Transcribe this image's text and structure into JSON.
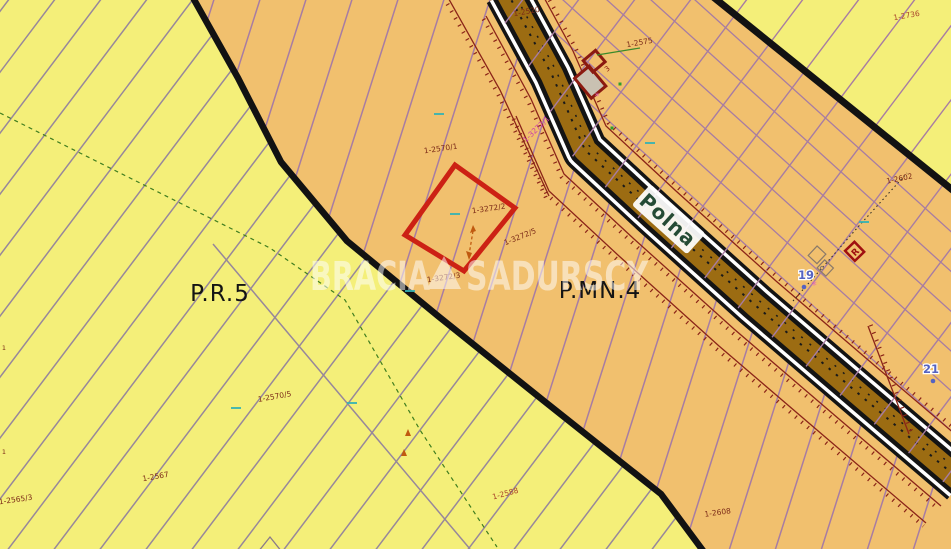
{
  "zones": {
    "left": "P.R.5",
    "right": "P.MN.4"
  },
  "road": {
    "name": "Polna"
  },
  "watermark": {
    "left": "BRACIA",
    "right": "SADURSCY"
  },
  "selected_parcel": {
    "label": "1-3272/2"
  },
  "labels": [
    {
      "t": "1-2520",
      "x": 527,
      "y": 14,
      "r": -10
    },
    {
      "t": "1-2575",
      "x": 640,
      "y": 45,
      "r": -10
    },
    {
      "t": "1-2736",
      "x": 907,
      "y": 18,
      "r": -10,
      "c": "#a8432a"
    },
    {
      "t": "1-2602",
      "x": 900,
      "y": 181,
      "r": -12
    },
    {
      "t": "1-2570/1",
      "x": 441,
      "y": 151,
      "r": -8
    },
    {
      "t": "1-3272/1",
      "x": 538,
      "y": 131,
      "r": -44,
      "c": "#cc3fa8"
    },
    {
      "t": "1-3272/2",
      "x": 489,
      "y": 211,
      "r": -8
    },
    {
      "t": "1-3272/5",
      "x": 521,
      "y": 239,
      "r": -22
    },
    {
      "t": "1-3272/3",
      "x": 444,
      "y": 280,
      "r": -8
    },
    {
      "t": "1-2570/5",
      "x": 275,
      "y": 399,
      "r": -10
    },
    {
      "t": "1-2567",
      "x": 156,
      "y": 479,
      "r": -10
    },
    {
      "t": "1-2565/3",
      "x": 16,
      "y": 502,
      "r": -8
    },
    {
      "t": "1-2588",
      "x": 506,
      "y": 496,
      "r": -15,
      "c": "#a8432a"
    },
    {
      "t": "1-2608",
      "x": 718,
      "y": 515,
      "r": -8
    },
    {
      "t": "1",
      "x": 4,
      "y": 350,
      "r": 0,
      "s": 6.5
    },
    {
      "t": "1",
      "x": 4,
      "y": 454,
      "r": 0,
      "s": 6.5
    }
  ],
  "markers": {
    "blue": [
      {
        "t": "19",
        "x": 806,
        "y": 279
      },
      {
        "t": "21",
        "x": 931,
        "y": 373
      }
    ],
    "r_box_label": "R",
    "building_label": "3"
  },
  "colors": {
    "yellow": "#f4ef79",
    "orange": "#f1c06e",
    "road_brown": "#9c6c12",
    "boundary": "#121212",
    "parcel_red": "#cc2114",
    "label": "#7b2a18",
    "pink": "#e668b8",
    "blue": "#5563c1",
    "green_dash": "#3f7d1f",
    "teal": "#35b3b3",
    "dark_red_line": "#8b2418",
    "purple_line": "#a77ca3",
    "gray_line": "#97879b",
    "zone_text": "#141414",
    "road_text": "#254b35",
    "watermark": "#ffffff"
  }
}
